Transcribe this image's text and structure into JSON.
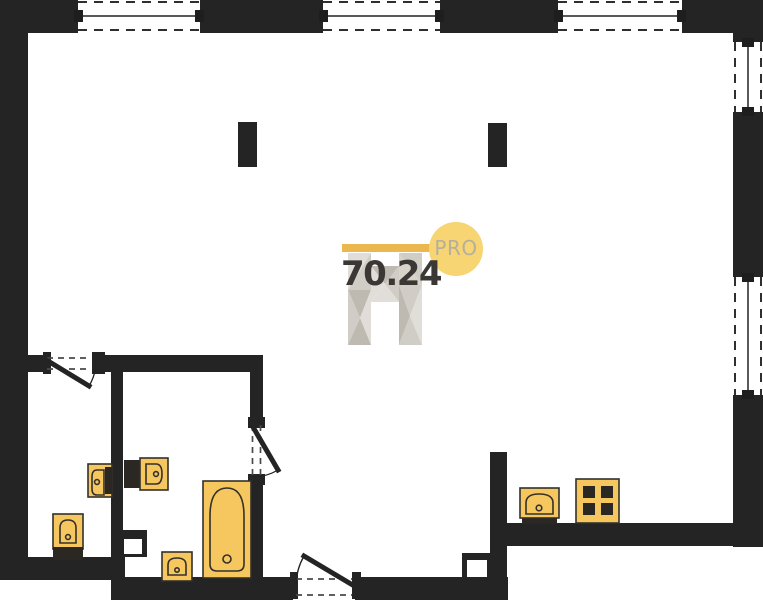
{
  "watermark": {
    "area": "70.24",
    "brand": "PRO",
    "bar": {
      "x": 342,
      "y": 244,
      "w": 92,
      "h": 8,
      "color": "#eab84e"
    },
    "circle": {
      "cx": 456,
      "cy": 249,
      "r": 27,
      "color": "#f6d572"
    },
    "logo_colors": [
      "#dedbd6",
      "#cbc7c0",
      "#b8b3aa",
      "#d6cfc4"
    ],
    "logo_polys": [
      [
        [
          348,
          253
        ],
        [
          371,
          253
        ],
        [
          348,
          290
        ],
        0
      ],
      [
        [
          371,
          253
        ],
        [
          371,
          290
        ],
        [
          348,
          290
        ],
        1
      ],
      [
        [
          348,
          290
        ],
        [
          371,
          290
        ],
        [
          360,
          318
        ],
        2
      ],
      [
        [
          348,
          290
        ],
        [
          360,
          318
        ],
        [
          348,
          345
        ],
        1
      ],
      [
        [
          360,
          318
        ],
        [
          371,
          290
        ],
        [
          371,
          345
        ],
        0
      ],
      [
        [
          348,
          345
        ],
        [
          360,
          318
        ],
        [
          371,
          345
        ],
        2
      ],
      [
        [
          399,
          253
        ],
        [
          422,
          253
        ],
        [
          422,
          285
        ],
        1
      ],
      [
        [
          399,
          253
        ],
        [
          422,
          285
        ],
        [
          399,
          285
        ],
        3
      ],
      [
        [
          399,
          285
        ],
        [
          422,
          285
        ],
        [
          410,
          316
        ],
        1
      ],
      [
        [
          399,
          285
        ],
        [
          410,
          316
        ],
        [
          399,
          345
        ],
        2
      ],
      [
        [
          422,
          285
        ],
        [
          422,
          345
        ],
        [
          410,
          316
        ],
        0
      ],
      [
        [
          399,
          345
        ],
        [
          410,
          316
        ],
        [
          422,
          345
        ],
        1
      ],
      [
        [
          371,
          266
        ],
        [
          399,
          266
        ],
        [
          385,
          284
        ],
        2
      ],
      [
        [
          371,
          266
        ],
        [
          385,
          284
        ],
        [
          371,
          302
        ],
        0
      ],
      [
        [
          399,
          266
        ],
        [
          399,
          302
        ],
        [
          385,
          284
        ],
        1
      ],
      [
        [
          371,
          302
        ],
        [
          385,
          284
        ],
        [
          399,
          302
        ],
        0
      ]
    ]
  },
  "colors": {
    "wall": "#242424",
    "fixture": "#f7c75f",
    "fixture_stroke": "#33302b",
    "dark": "#2b2824",
    "door_dash": "#4a4a4a",
    "arc": "#222222"
  },
  "plan": {
    "width": 763,
    "height": 600,
    "walls": [
      {
        "name": "outer-top-left-corner",
        "x": 0,
        "y": 0,
        "w": 78,
        "h": 33
      },
      {
        "name": "outer-top-segment-a",
        "x": 200,
        "y": 0,
        "w": 123,
        "h": 33
      },
      {
        "name": "outer-top-segment-b",
        "x": 440,
        "y": 0,
        "w": 118,
        "h": 33
      },
      {
        "name": "outer-top-right-corner",
        "x": 682,
        "y": 0,
        "w": 81,
        "h": 33
      },
      {
        "name": "outer-right-corner-ext",
        "x": 733,
        "y": 33,
        "w": 30,
        "h": 9
      },
      {
        "name": "outer-right-segment-a",
        "x": 733,
        "y": 112,
        "w": 30,
        "h": 165
      },
      {
        "name": "outer-right-segment-b",
        "x": 733,
        "y": 395,
        "w": 30,
        "h": 152
      },
      {
        "name": "kitchen-bottom-wall",
        "x": 505,
        "y": 523,
        "w": 258,
        "h": 23
      },
      {
        "name": "kitchen-left-wall",
        "x": 490,
        "y": 452,
        "w": 17,
        "h": 148
      },
      {
        "name": "bottom-wall-left-of-entrance",
        "x": 111,
        "y": 577,
        "w": 182,
        "h": 23
      },
      {
        "name": "bottom-wall-right-of-entrance",
        "x": 355,
        "y": 577,
        "w": 153,
        "h": 23
      },
      {
        "name": "wc-bottom-wall",
        "x": 0,
        "y": 557,
        "w": 125,
        "h": 23
      },
      {
        "name": "outer-left-wall",
        "x": 0,
        "y": 33,
        "w": 28,
        "h": 547
      },
      {
        "name": "bath-top-wall-left",
        "x": 0,
        "y": 355,
        "w": 45,
        "h": 17
      },
      {
        "name": "bath-top-wall-right",
        "x": 92,
        "y": 355,
        "w": 171,
        "h": 17
      },
      {
        "name": "wc-bath-divider-wall",
        "x": 111,
        "y": 372,
        "w": 12,
        "h": 165
      },
      {
        "name": "bath-right-wall-upper",
        "x": 250,
        "y": 355,
        "w": 13,
        "h": 67
      },
      {
        "name": "bath-right-wall-lower",
        "x": 250,
        "y": 478,
        "w": 13,
        "h": 99
      }
    ],
    "columns": [
      {
        "name": "column-left",
        "x": 238,
        "y": 122,
        "w": 19,
        "h": 45
      },
      {
        "name": "column-right",
        "x": 488,
        "y": 123,
        "w": 19,
        "h": 44
      }
    ],
    "shafts": [
      {
        "name": "shaft-wc",
        "box": [
          111,
          530,
          36,
          27
        ],
        "hole": [
          124,
          539,
          18,
          15
        ]
      },
      {
        "name": "shaft-entrance",
        "box": [
          462,
          553,
          31,
          30
        ],
        "hole": [
          467,
          560,
          20,
          17
        ]
      }
    ],
    "windows": [
      {
        "name": "window-top-1",
        "o": "h",
        "x": 78,
        "y": 0,
        "w": 122,
        "h": 33
      },
      {
        "name": "window-top-2",
        "o": "h",
        "x": 323,
        "y": 0,
        "w": 117,
        "h": 33
      },
      {
        "name": "window-top-3",
        "o": "h",
        "x": 558,
        "y": 0,
        "w": 124,
        "h": 33
      },
      {
        "name": "window-right-1",
        "o": "v",
        "x": 733,
        "y": 42,
        "w": 30,
        "h": 70
      },
      {
        "name": "window-right-2",
        "o": "v",
        "x": 733,
        "y": 277,
        "w": 30,
        "h": 118
      }
    ],
    "doors": [
      {
        "name": "wc-door",
        "caps": [
          [
            43,
            352,
            8,
            22
          ],
          [
            92,
            352,
            13,
            22
          ]
        ],
        "dashes": [
          [
            47,
            358,
            91,
            358
          ],
          [
            47,
            369,
            91,
            369
          ]
        ],
        "leaf": [
          48,
          361,
          89,
          386
        ],
        "arc": "M89,386 A48,48 0 0 0 96,363"
      },
      {
        "name": "bathroom-door",
        "caps": [
          [
            248,
            417,
            17,
            11
          ],
          [
            248,
            474,
            17,
            11
          ]
        ],
        "dashes": [
          [
            252.5,
            425,
            252.5,
            476
          ],
          [
            260.5,
            425,
            260.5,
            476
          ]
        ],
        "leaf": [
          253,
          427,
          278,
          470
        ],
        "arc": "M278,470 A50,50 0 0 1 253,477"
      },
      {
        "name": "entrance-door",
        "caps": [
          [
            290,
            572,
            8,
            27
          ],
          [
            352,
            572,
            9,
            27
          ]
        ],
        "dashes": [
          [
            296,
            579,
            352,
            579
          ],
          [
            296,
            595,
            352,
            595
          ]
        ],
        "leaf": [
          356,
          587,
          304,
          556
        ],
        "arc": "M304,556 A61,61 0 0 0 296,584"
      }
    ],
    "fixtures": [
      {
        "name": "wc-toilet",
        "shapes": [
          {
            "t": "rect",
            "x": 88,
            "y": 464,
            "w": 24,
            "h": 33,
            "fill": "f",
            "stroke": true
          },
          {
            "t": "rect",
            "x": 105,
            "y": 467,
            "w": 7,
            "h": 27,
            "fill": "d"
          },
          {
            "t": "path",
            "d": "M104,470 L97,470 Q92,470 92,477 L92,489 Q92,495 97,495 L104,495 Z",
            "fill": "f",
            "stroke": true
          },
          {
            "t": "circle",
            "cx": 97,
            "cy": 482,
            "r": 2.4,
            "fill": "f",
            "stroke": true
          }
        ]
      },
      {
        "name": "wc-bidet",
        "shapes": [
          {
            "t": "rect",
            "x": 53,
            "y": 514,
            "w": 30,
            "h": 35,
            "fill": "f",
            "stroke": true
          },
          {
            "t": "rect",
            "x": 53,
            "y": 547,
            "w": 30,
            "h": 13,
            "fill": "d"
          },
          {
            "t": "path",
            "d": "M60,543 L60,528 Q60,520 68,520 Q76,520 76,528 L76,543 Z",
            "fill": "f",
            "stroke": true
          },
          {
            "t": "circle",
            "cx": 68,
            "cy": 537,
            "r": 2.4,
            "fill": "f",
            "stroke": true
          }
        ]
      },
      {
        "name": "bath-vanity-counter",
        "shapes": [
          {
            "t": "rect",
            "x": 124,
            "y": 460,
            "w": 18,
            "h": 28,
            "fill": "d"
          }
        ]
      },
      {
        "name": "bath-vanity-sink",
        "shapes": [
          {
            "t": "rect",
            "x": 140,
            "y": 458,
            "w": 28,
            "h": 32,
            "fill": "f",
            "stroke": true
          },
          {
            "t": "path",
            "d": "M146,464 L156,464 Q162,464 162,474 Q162,484 156,484 L146,484 Z",
            "fill": "f",
            "stroke": true
          },
          {
            "t": "circle",
            "cx": 156,
            "cy": 474,
            "r": 2.4,
            "fill": "f",
            "stroke": true
          }
        ]
      },
      {
        "name": "bathtub",
        "shapes": [
          {
            "t": "rect",
            "x": 203,
            "y": 481,
            "w": 48,
            "h": 97,
            "fill": "f",
            "stroke": true
          },
          {
            "t": "path",
            "d": "M210,516 Q210,488 227,488 Q244,488 244,516 L244,564 Q244,571 237,571 L217,571 Q210,571 210,564 Z",
            "fill": "f",
            "stroke": true
          },
          {
            "t": "circle",
            "cx": 227,
            "cy": 559,
            "r": 4,
            "fill": "f",
            "stroke": true
          }
        ]
      },
      {
        "name": "bath-washbasin",
        "shapes": [
          {
            "t": "rect",
            "x": 162,
            "y": 552,
            "w": 30,
            "h": 29,
            "fill": "f",
            "stroke": true
          },
          {
            "t": "path",
            "d": "M168,575 L168,565 Q168,558 177,558 Q186,558 186,565 L186,575 Z",
            "fill": "f",
            "stroke": true
          },
          {
            "t": "circle",
            "cx": 177,
            "cy": 570,
            "r": 2.2,
            "fill": "f",
            "stroke": true
          }
        ]
      },
      {
        "name": "kitchen-sink",
        "shapes": [
          {
            "t": "rect",
            "x": 522,
            "y": 516,
            "w": 35,
            "h": 8,
            "fill": "d"
          },
          {
            "t": "rect",
            "x": 520,
            "y": 488,
            "w": 39,
            "h": 30,
            "fill": "f",
            "stroke": true
          },
          {
            "t": "path",
            "d": "M526,514 L526,503 Q526,494 539,494 Q553,494 553,503 L553,514 Z",
            "fill": "f",
            "stroke": true
          },
          {
            "t": "circle",
            "cx": 539,
            "cy": 508,
            "r": 2.8,
            "fill": "f",
            "stroke": true
          }
        ]
      },
      {
        "name": "kitchen-stove",
        "shapes": [
          {
            "t": "rect",
            "x": 579,
            "y": 517,
            "w": 38,
            "h": 7,
            "fill": "d"
          },
          {
            "t": "rect",
            "x": 576,
            "y": 479,
            "w": 43,
            "h": 44,
            "fill": "f",
            "stroke": true
          },
          {
            "t": "rect",
            "x": 583,
            "y": 486,
            "w": 12,
            "h": 12,
            "fill": "d"
          },
          {
            "t": "rect",
            "x": 601,
            "y": 486,
            "w": 12,
            "h": 12,
            "fill": "d"
          },
          {
            "t": "rect",
            "x": 583,
            "y": 503,
            "w": 12,
            "h": 12,
            "fill": "d"
          },
          {
            "t": "rect",
            "x": 601,
            "y": 503,
            "w": 12,
            "h": 12,
            "fill": "d"
          }
        ]
      }
    ]
  }
}
